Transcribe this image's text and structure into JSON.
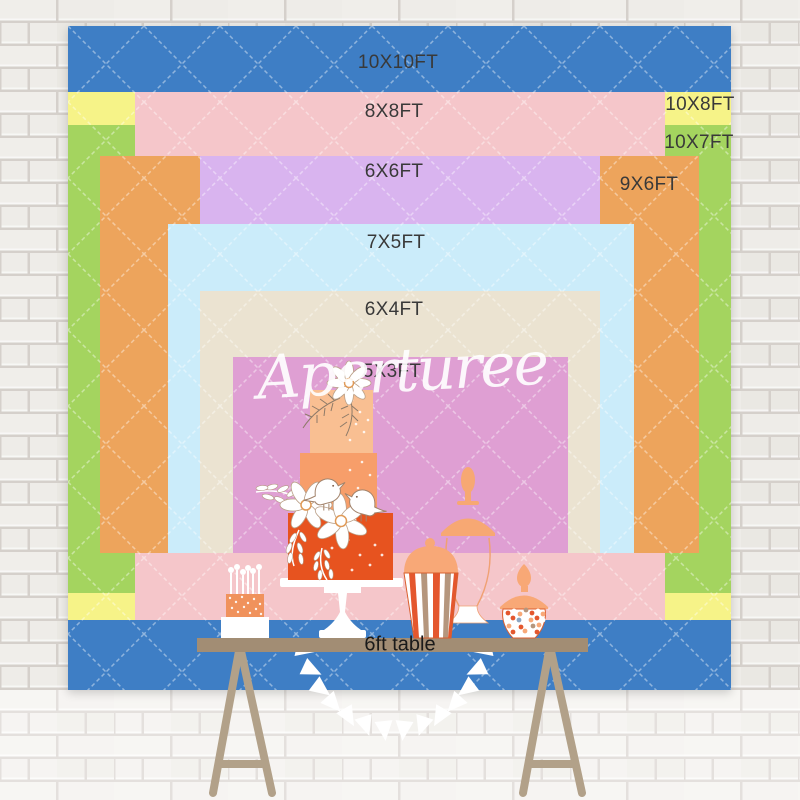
{
  "watermark": {
    "text": "Aperturee"
  },
  "table": {
    "label": "6ft table",
    "color": "#a28d74"
  },
  "backdrop_sizes": [
    {
      "label": "10X10FT",
      "color": "#3e7ec5"
    },
    {
      "label": "10X8FT",
      "color": "#f6f388"
    },
    {
      "label": "10X7FT",
      "color": "#a4d45f"
    },
    {
      "label": "8X8FT",
      "color": "#f5c6ca"
    },
    {
      "label": "9X6FT",
      "color": "#eda45c"
    },
    {
      "label": "6X6FT",
      "color": "#d9b4ef"
    },
    {
      "label": "7X5FT",
      "color": "#cbecfa"
    },
    {
      "label": "6X4FT",
      "color": "#ebe3d1"
    },
    {
      "label": "5X3FT",
      "color": "#df9fd3"
    }
  ],
  "scene_colors": {
    "wall_brick": "#f2f0ec",
    "wall_mortar": "#d8d3ce",
    "cake_tier_top": "#f9bf92",
    "cake_tier_middle": "#f79e6a",
    "cake_tier_bottom": "#e7531f",
    "dessert_peach": "#f8a877",
    "stripe_red": "#e4572e",
    "stripe_taupe": "#b5967d",
    "label_text": "#393939"
  }
}
